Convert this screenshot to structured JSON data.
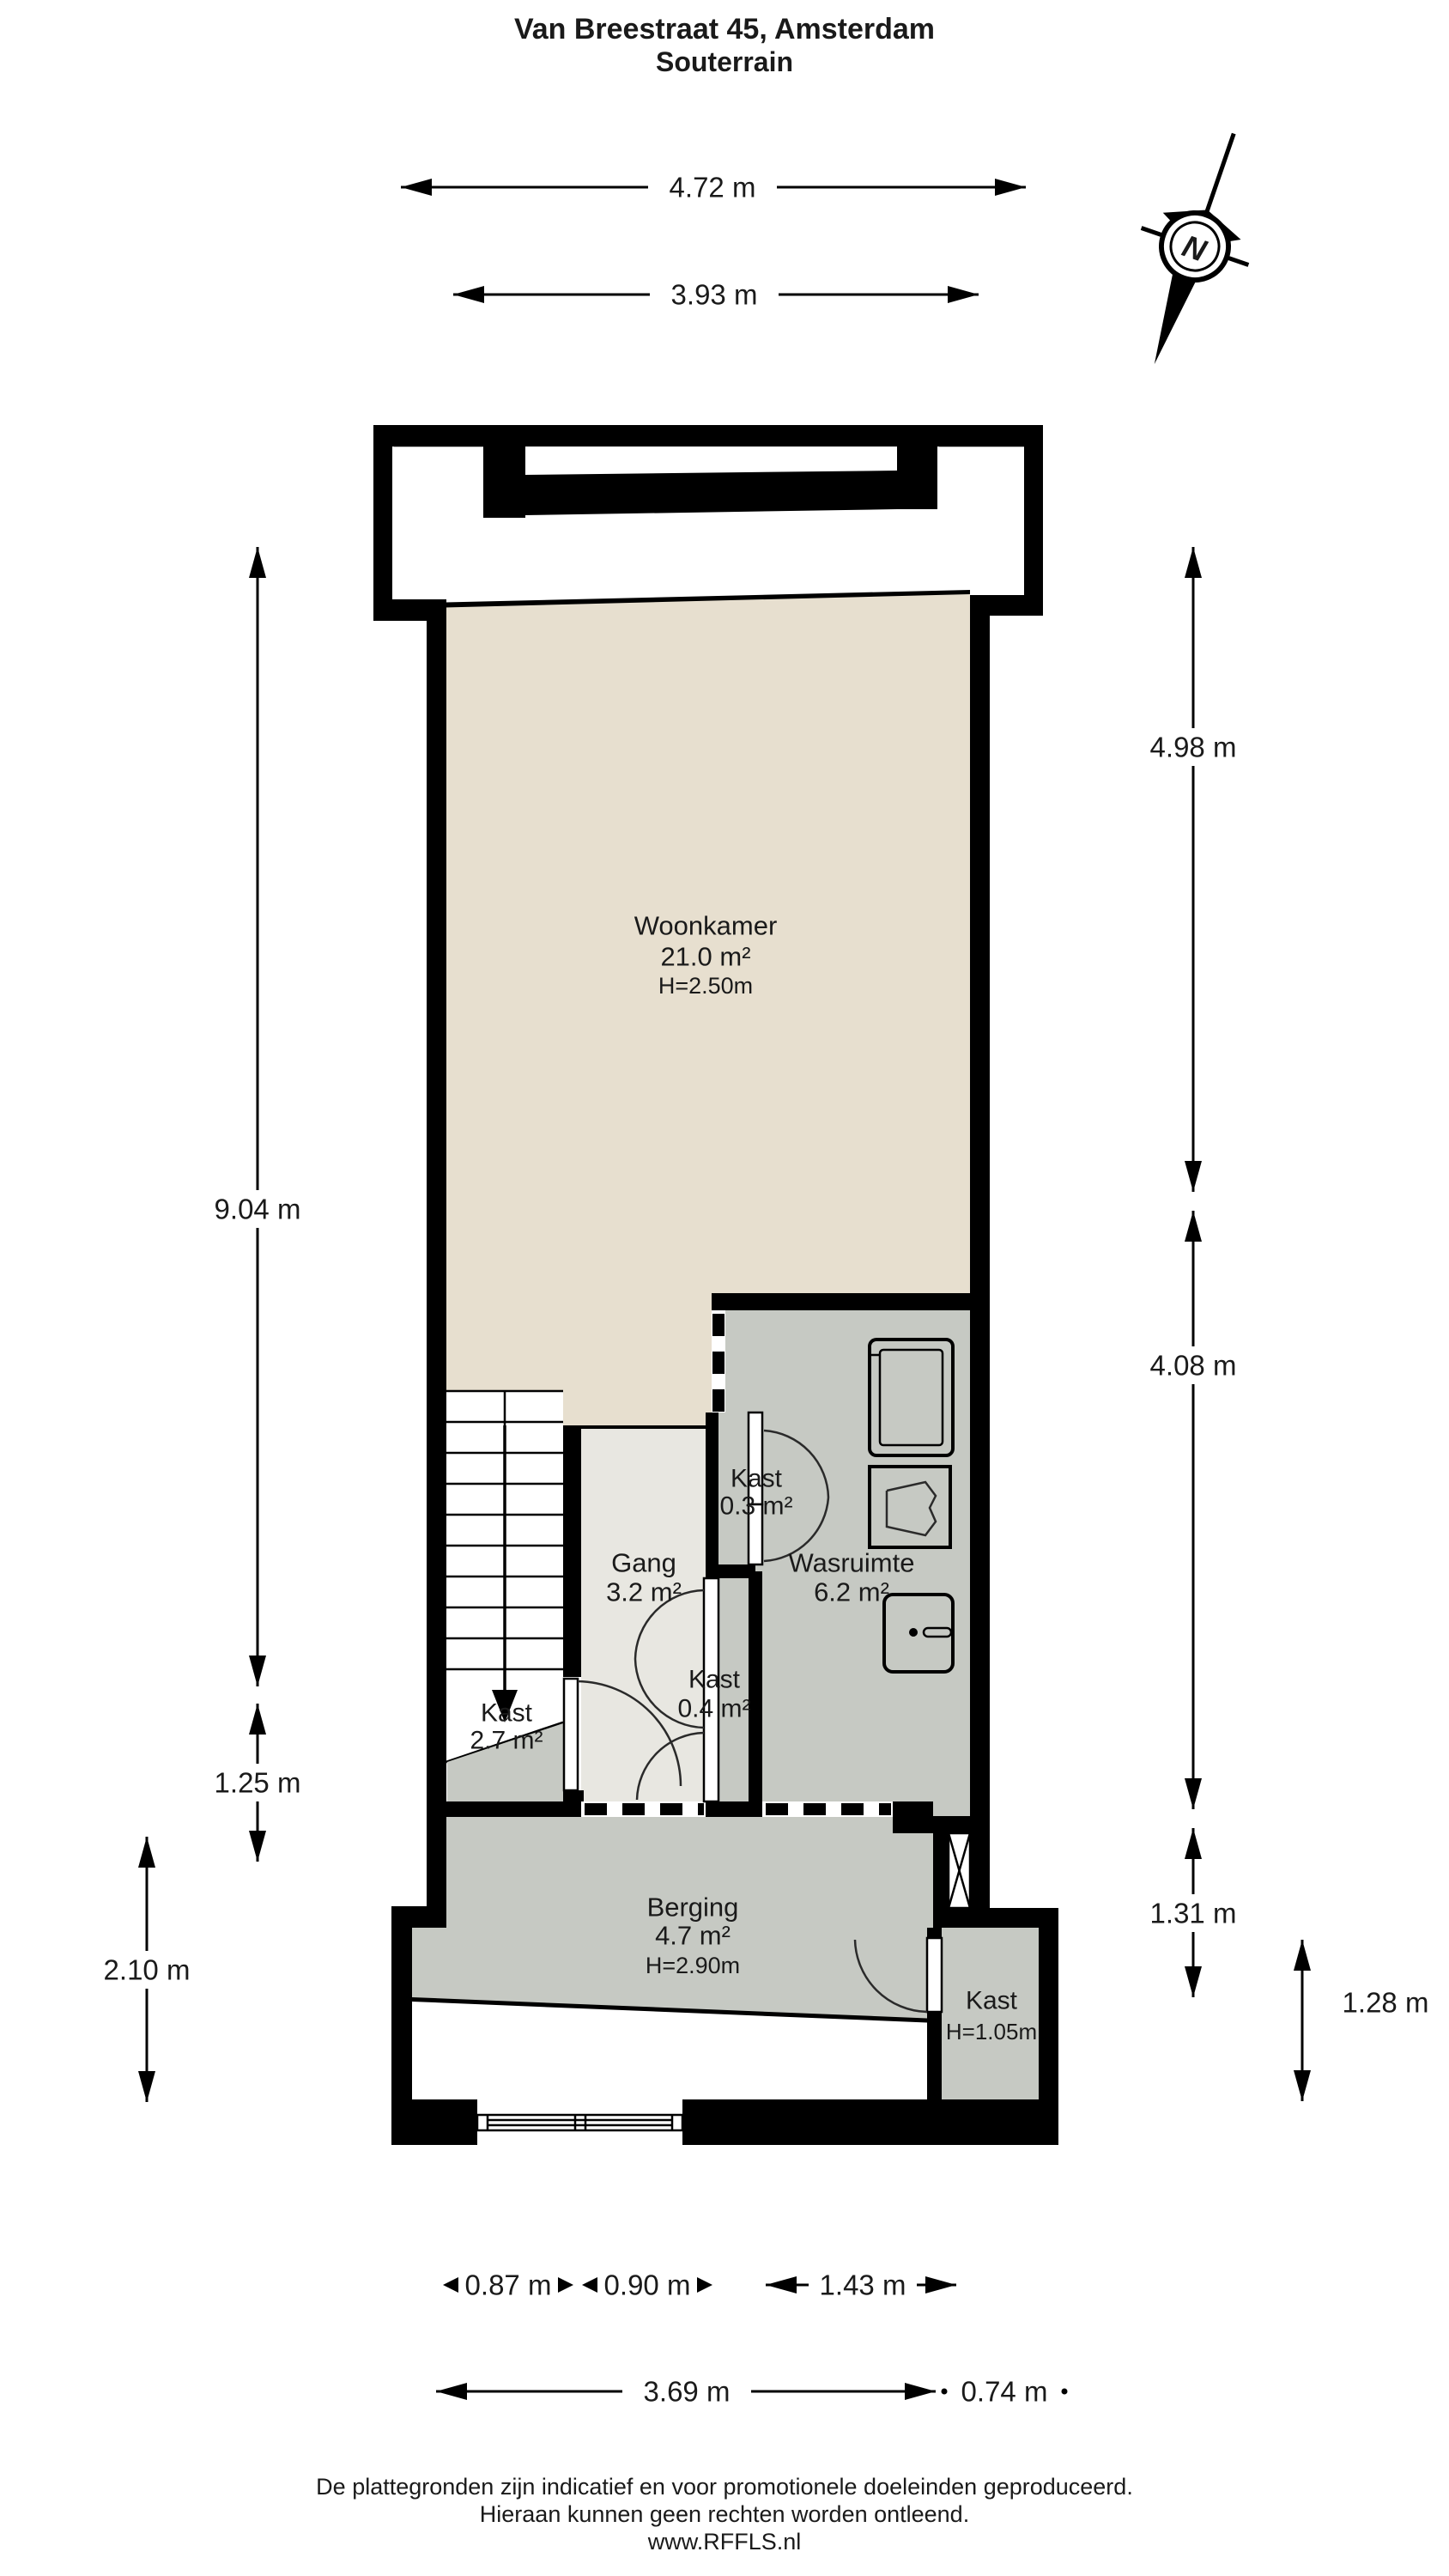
{
  "title": {
    "line1": "Van Breestraat 45, Amsterdam",
    "line2": "Souterrain"
  },
  "rooms": {
    "woonkamer": {
      "name": "Woonkamer",
      "area": "21.0 m²",
      "height": "H=2.50m"
    },
    "gang": {
      "name": "Gang",
      "area": "3.2 m²"
    },
    "kast_klein": {
      "name": "Kast",
      "area": "0.3 m²"
    },
    "wasruimte": {
      "name": "Wasruimte",
      "area": "6.2 m²"
    },
    "kast_midden": {
      "name": "Kast",
      "area": "0.4 m²"
    },
    "kast_links": {
      "name": "Kast",
      "area": "2.7 m²"
    },
    "berging": {
      "name": "Berging",
      "area": "4.7 m²",
      "height": "H=2.90m"
    },
    "kast_onder": {
      "name": "Kast",
      "height": "H=1.05m"
    }
  },
  "dimensions": {
    "top": {
      "d1": "4.72 m",
      "d2": "3.93 m"
    },
    "left": {
      "d1": "9.04 m",
      "d2": "1.25 m",
      "d3": "2.10 m"
    },
    "right": {
      "d1": "4.98 m",
      "d2": "4.08 m",
      "d3": "1.31 m",
      "d4": "1.28 m"
    },
    "bottom": {
      "d1": "0.87 m",
      "d2": "0.90 m",
      "d3": "1.43 m",
      "d4": "3.69 m",
      "d5": "0.74 m"
    }
  },
  "compass": {
    "label": "N"
  },
  "footer": {
    "line1": "De plattegronden zijn indicatief en voor promotionele doeleinden geproduceerd.",
    "line2": "Hieraan kunnen geen rechten worden ontleend.",
    "line3": "www.RFFLS.nl"
  },
  "colors": {
    "wall": "#000000",
    "floor-beige": "#e7dfcf",
    "floor-gray": "#c6c9c3",
    "floor-light": "#e8e7e1",
    "bg": "#ffffff",
    "ink": "#1a1a1a"
  }
}
